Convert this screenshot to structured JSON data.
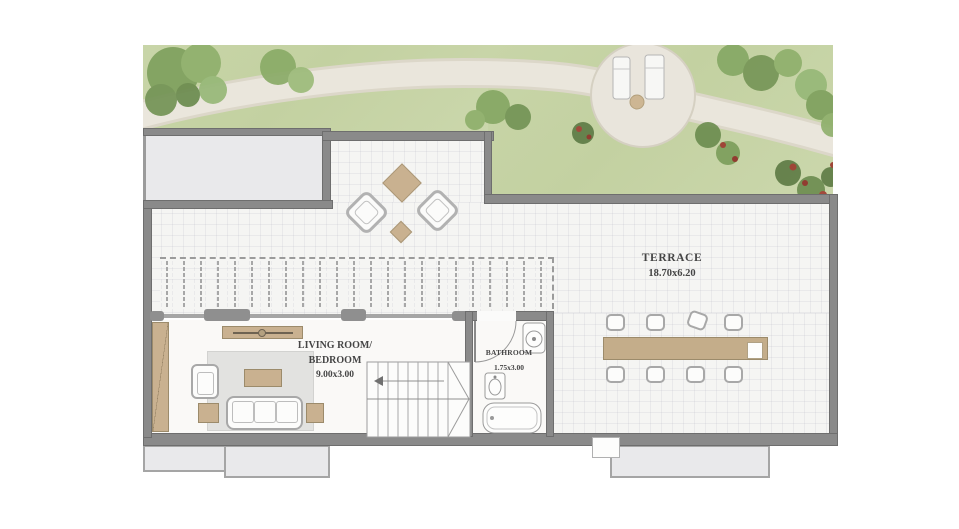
{
  "labels": {
    "terrace": {
      "name": "TERRACE",
      "dims": "18.70x6.20"
    },
    "living_room": {
      "line1": "LIVING ROOM/",
      "line2": "BEDROOM",
      "dims": "9.00x3.00"
    },
    "bathroom": {
      "name": "BATHROOM",
      "dims": "1.75x3.00"
    }
  },
  "colors": {
    "grass": "#c6d3a4",
    "path_stone": "#e9e5da",
    "wall": "#8a8a8a",
    "wood": "#c9b190",
    "terrace_floor": "#f5f5f3",
    "neighbour_block": "#e9e9eb",
    "text": "#454545"
  },
  "furniture": {
    "garden": [
      "winding-path",
      "round-patio",
      "sun-lounger",
      "sun-lounger",
      "patio-table",
      "trees",
      "flower-bushes"
    ],
    "terrace": [
      "diamond-lounge-chair",
      "diamond-lounge-chair",
      "diamond-table",
      "diamond-side-table",
      "pergola-louvers",
      "dining-table",
      "dining-chairs-x8"
    ],
    "living_room": [
      "wardrobe",
      "tv-console",
      "armchair",
      "rug",
      "coffee-table",
      "sofa",
      "side-table",
      "side-table"
    ],
    "bathroom": [
      "door",
      "toilet",
      "sink",
      "bathtub"
    ],
    "circulation": [
      "staircase"
    ]
  }
}
